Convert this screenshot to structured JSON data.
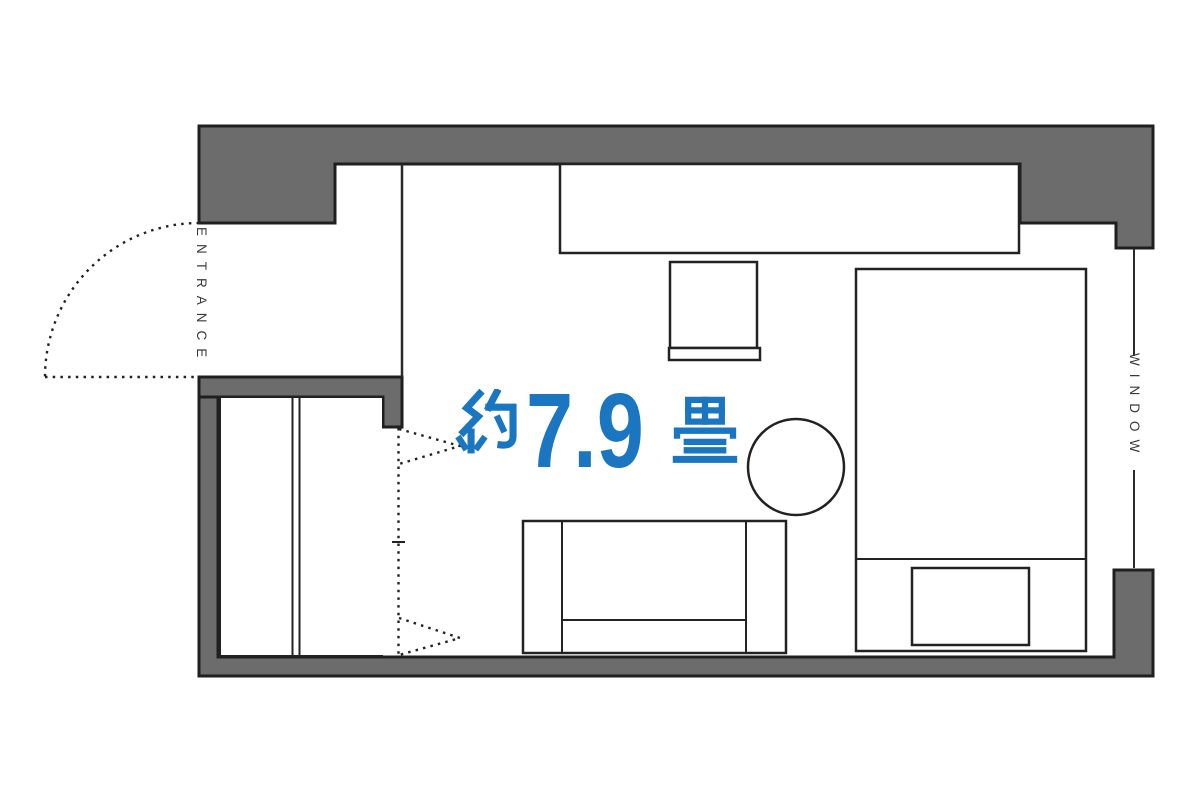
{
  "labels": {
    "entrance": "ENTRANCE",
    "window": "WINDOW"
  },
  "room": {
    "area_label": "約7.9畳",
    "area_prefix": "約",
    "area_number": "7.9",
    "area_suffix": "畳"
  },
  "colors": {
    "wall_fill": "#6C6C6C",
    "wall_outline": "#1F1F1F",
    "line_color": "#222222",
    "accent_blue": "#1A76C0",
    "background": "#FFFFFF"
  }
}
